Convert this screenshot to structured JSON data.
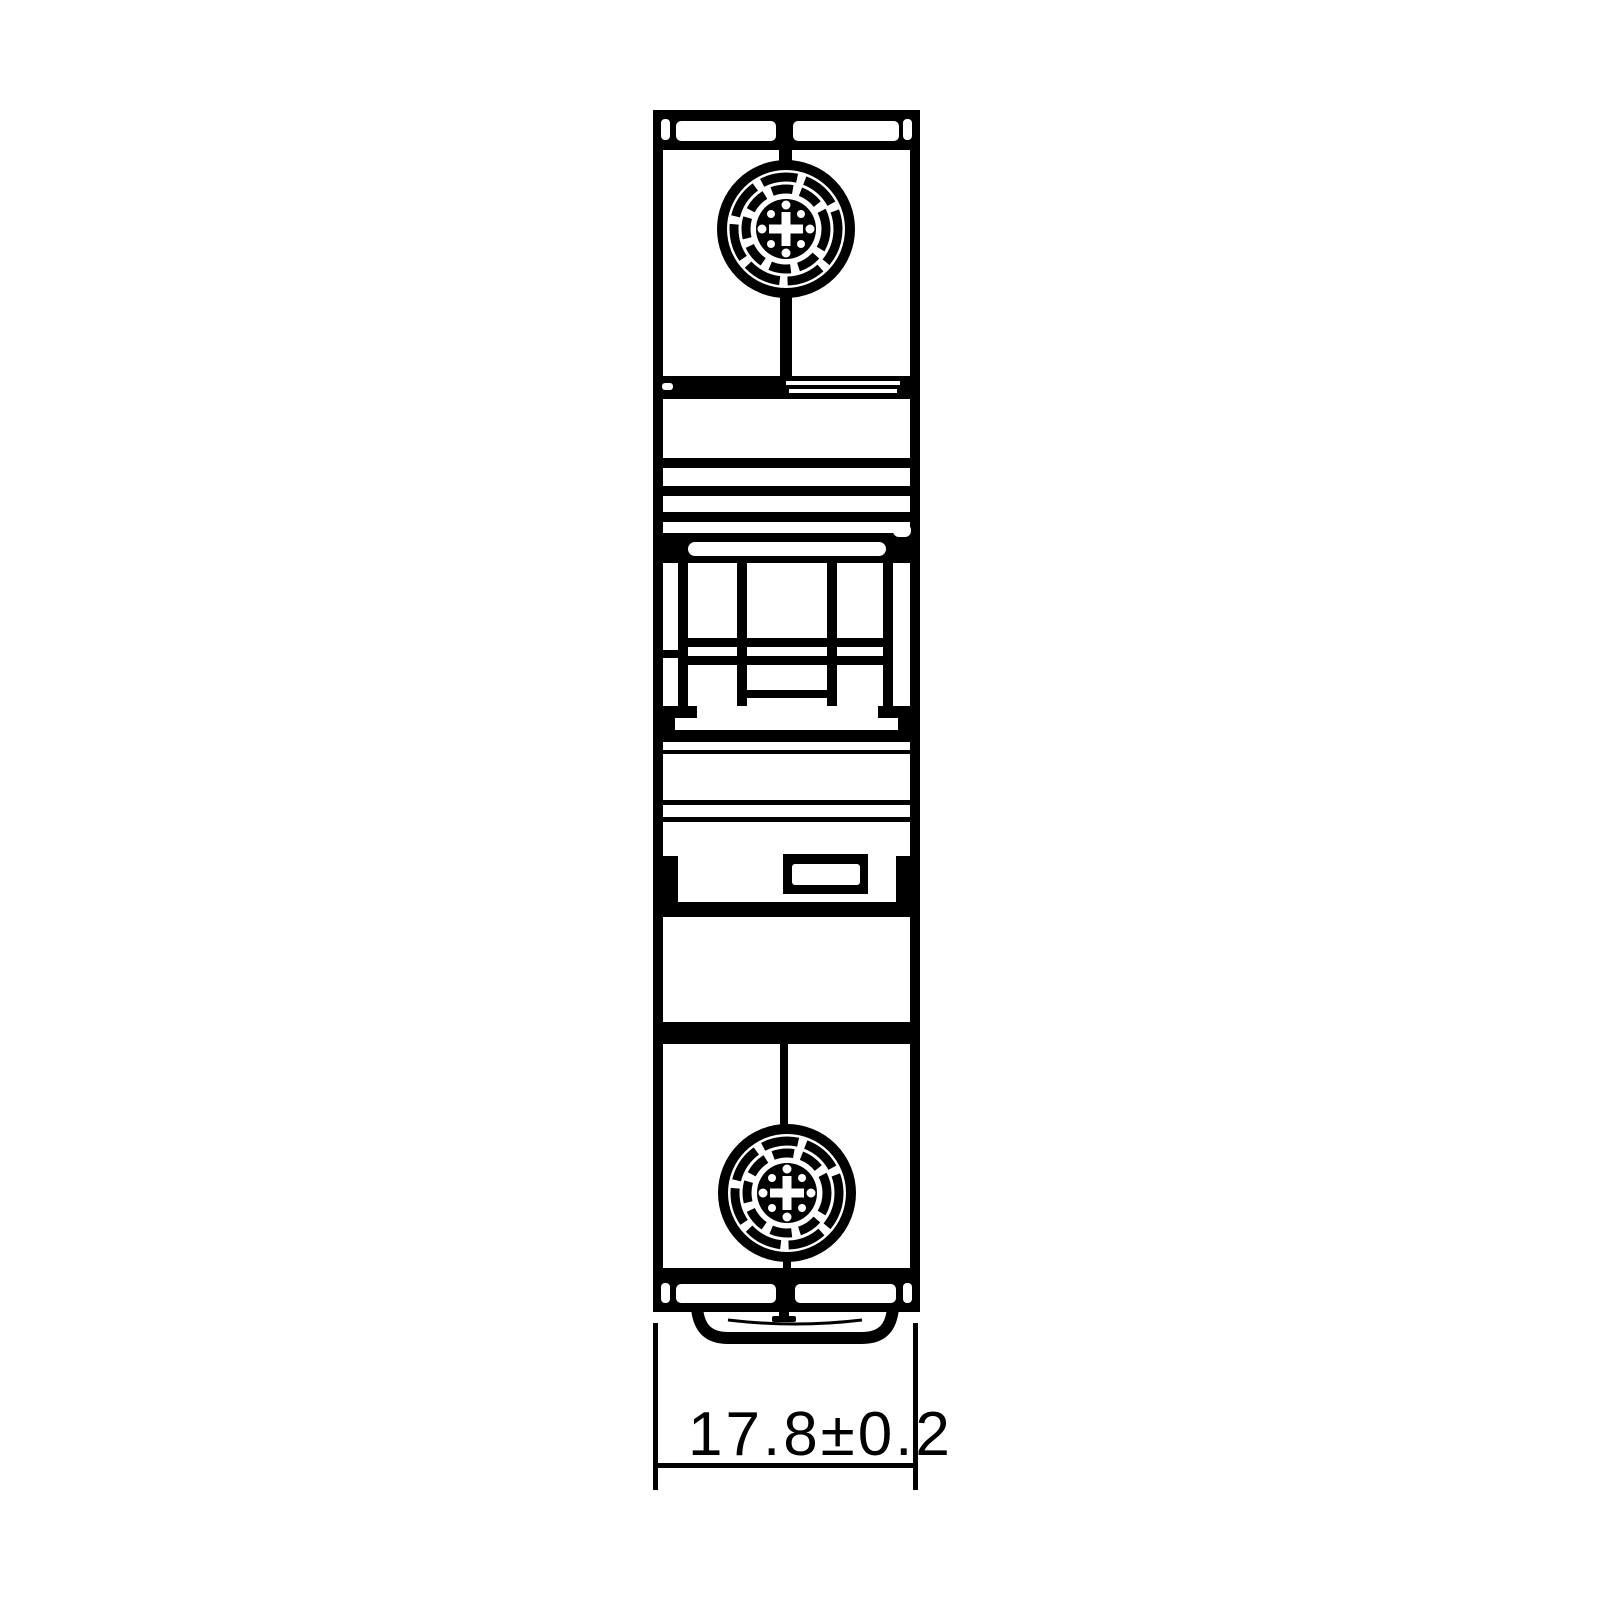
{
  "drawing": {
    "kind": "technical-outline-drawing",
    "subject": "1-pole miniature circuit breaker, front view",
    "dimension": {
      "label": "17.8±0.2",
      "value": "17.8",
      "tolerance": "±0.2"
    },
    "colors": {
      "line": "#000000",
      "background": "#ffffff"
    },
    "icons": {
      "top_terminal": "screw-head-icon",
      "bottom_terminal": "screw-head-icon",
      "mount": "din-rail-clip"
    }
  }
}
